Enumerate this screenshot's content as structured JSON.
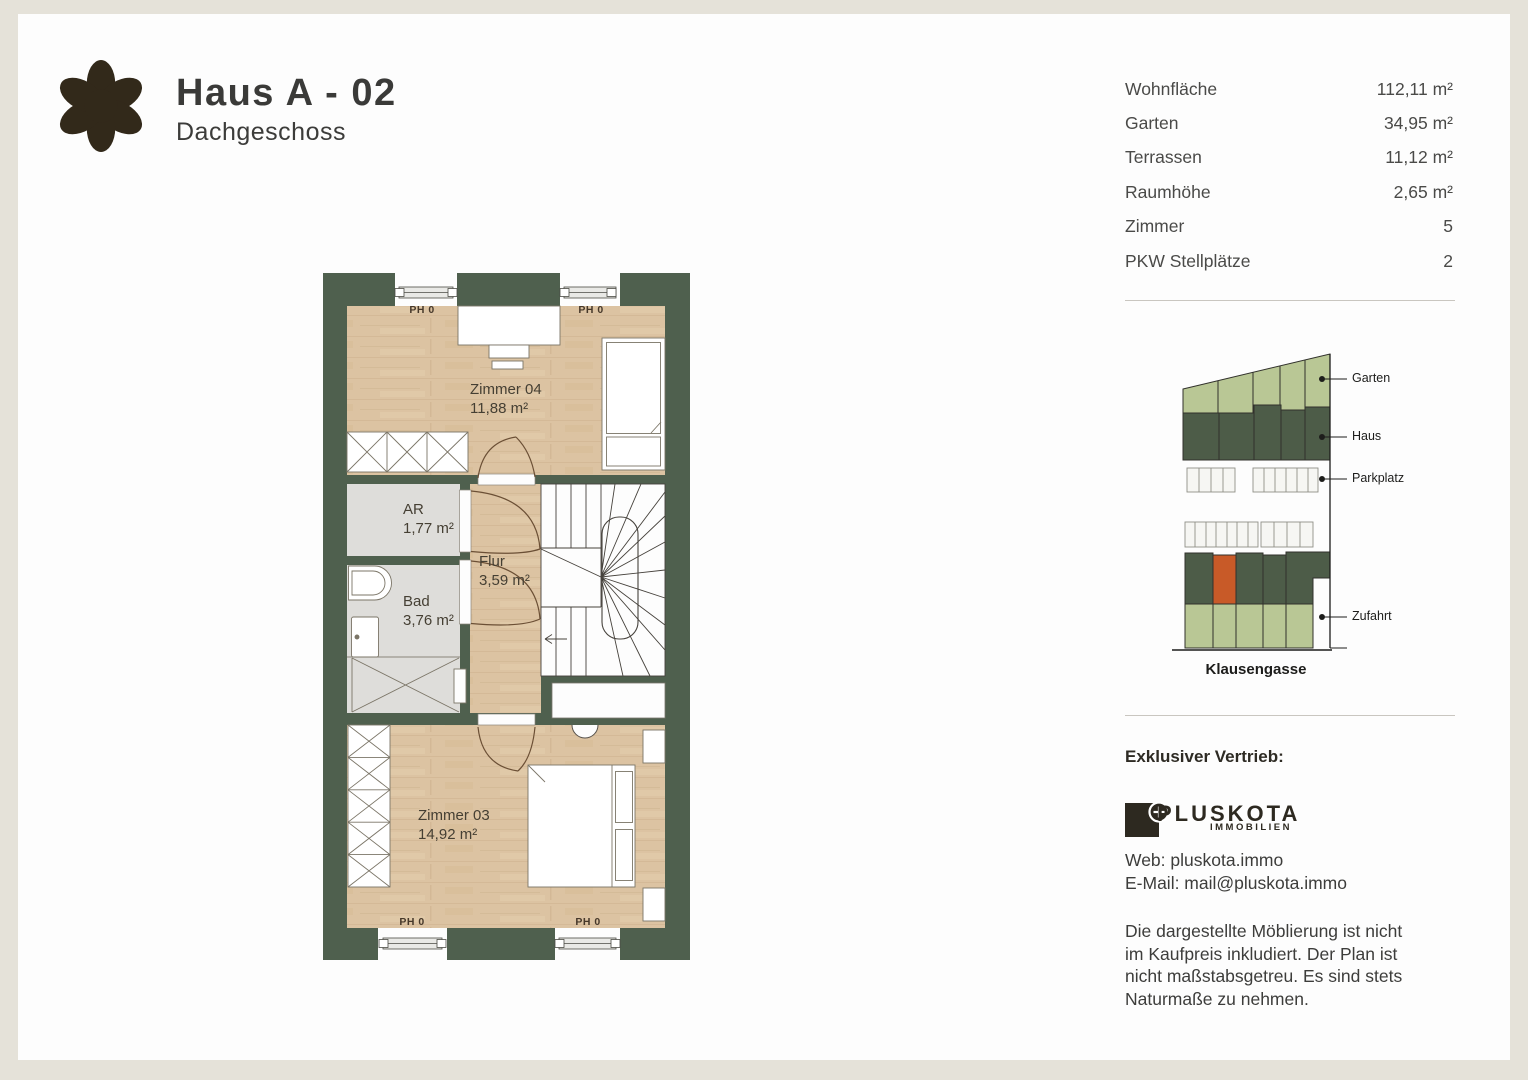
{
  "header": {
    "title": "Haus A - 02",
    "subtitle": "Dachgeschoss"
  },
  "details": {
    "rows": [
      {
        "label": "Wohnfläche",
        "value": "112,11 m²"
      },
      {
        "label": "Garten",
        "value": "34,95 m²"
      },
      {
        "label": "Terrassen",
        "value": "11,12 m²"
      },
      {
        "label": "Raumhöhe",
        "value": "2,65 m²"
      },
      {
        "label": "Zimmer",
        "value": "5"
      },
      {
        "label": "PKW Stellplätze",
        "value": "2"
      }
    ]
  },
  "floorplan": {
    "window_label": "PH 0",
    "rooms": {
      "zimmer04": {
        "name": "Zimmer 04",
        "area": "11,88 m²"
      },
      "ar": {
        "name": "AR",
        "area": "1,77 m²"
      },
      "bad": {
        "name": "Bad",
        "area": "3,76 m²"
      },
      "flur": {
        "name": "Flur",
        "area": "3,59 m²"
      },
      "zimmer03": {
        "name": "Zimmer 03",
        "area": "14,92 m²"
      }
    },
    "colors": {
      "wall": "#4f604e",
      "wood": "#dcc3a2",
      "tile": "#deddda"
    }
  },
  "siteplan": {
    "legend": [
      {
        "label": "Garten"
      },
      {
        "label": "Haus"
      },
      {
        "label": "Parkplatz"
      },
      {
        "label": "Zufahrt"
      }
    ],
    "street": "Klausengasse",
    "colors": {
      "garden": "#b9c795",
      "house": "#4d5c48",
      "highlight": "#c85a28"
    }
  },
  "vendor": {
    "heading": "Exklusiver Vertrieb:",
    "brand": "PLUSKOTA",
    "brand_sub": "IMMOBILIEN",
    "web": "Web: pluskota.immo",
    "email": "E-Mail: mail@pluskota.immo",
    "disclaimer_lines": [
      "Die dargestellte Möblierung ist nicht",
      "im Kaufpreis inkludiert. Der Plan ist",
      "nicht maßstabsgetreu. Es sind stets",
      "Naturmaße zu nehmen."
    ]
  }
}
